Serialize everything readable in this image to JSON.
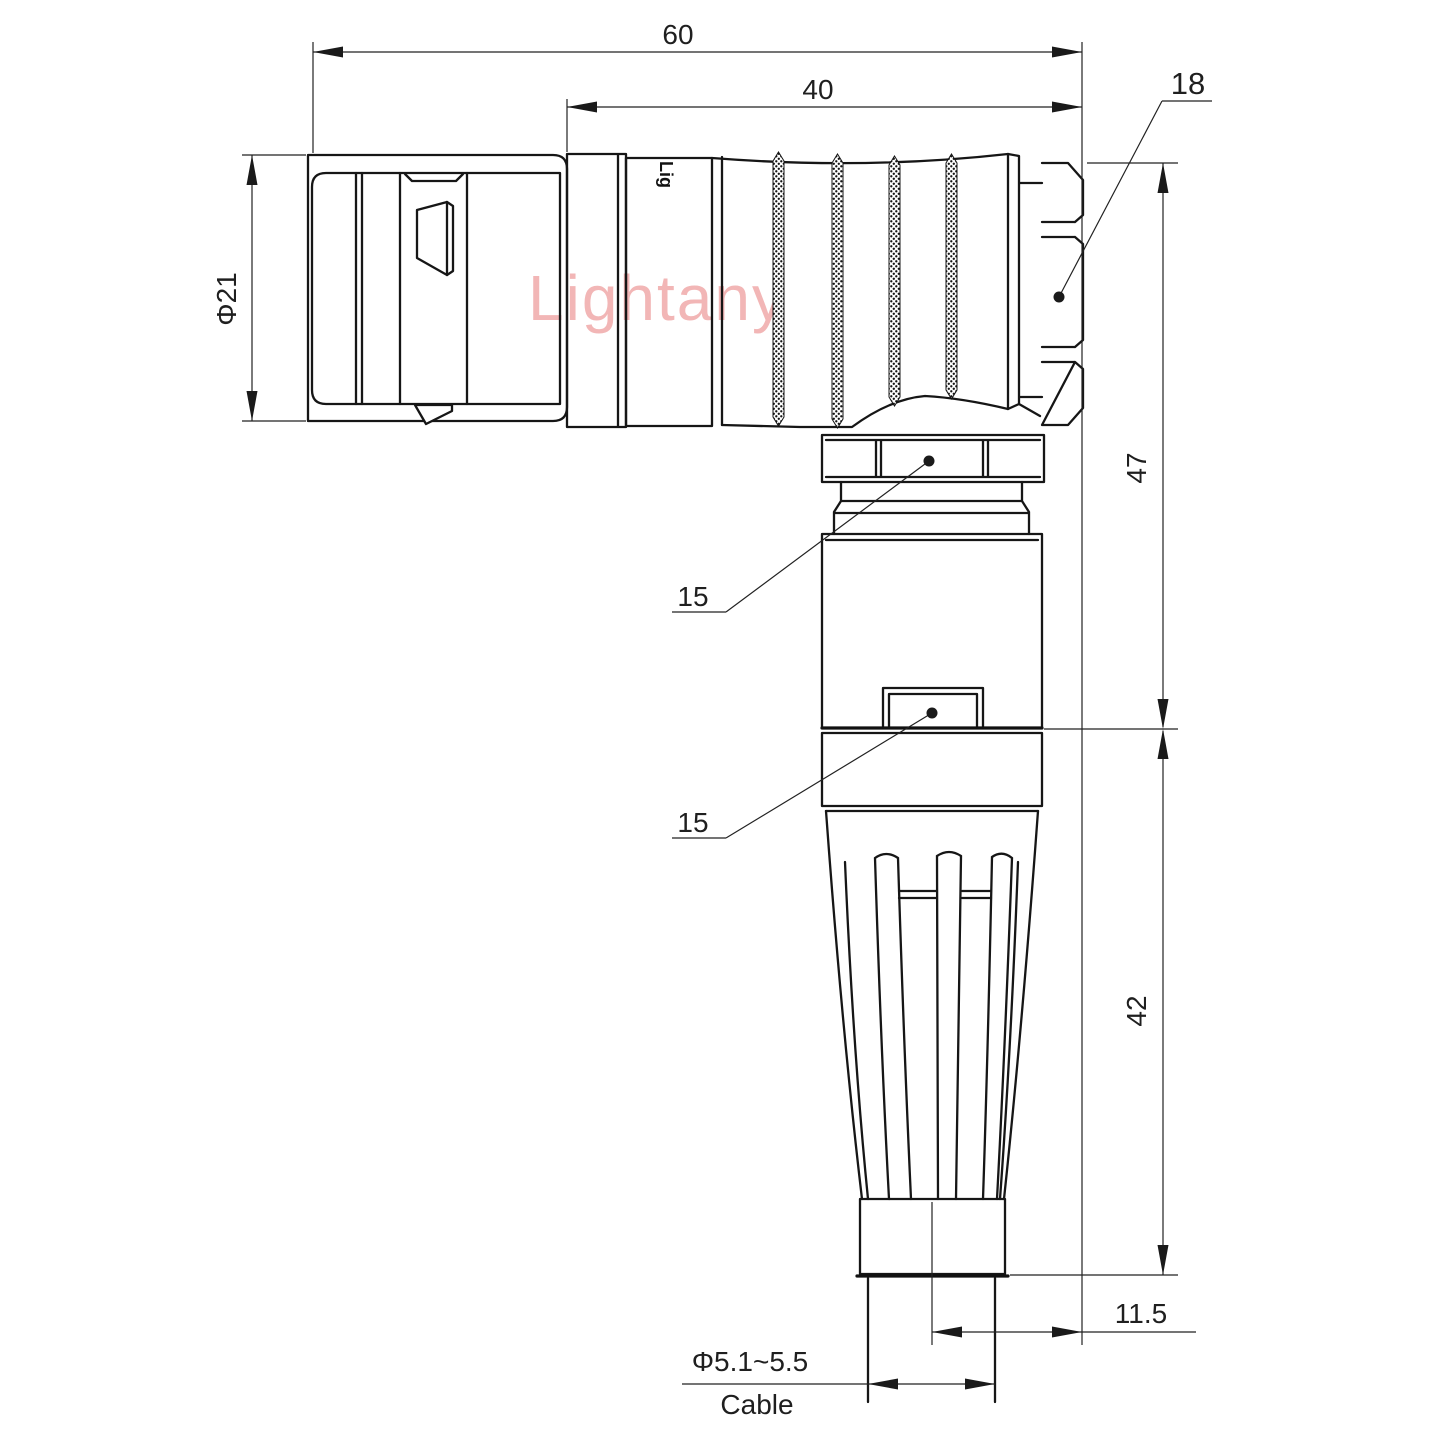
{
  "watermark": {
    "brand": "Lightany"
  },
  "engraving": {
    "text": "Lig"
  },
  "dimensions": {
    "overall_length": "60",
    "rear_section_length": "40",
    "nut_across_flats": "18",
    "shell_diameter": "Φ21",
    "upper_height": "47",
    "coupling_nut_flats": "15",
    "housing_flats": "15",
    "lower_height": "42",
    "axis_to_face_offset": "11.5",
    "cable_diameter_range": "Φ5.1~5.5",
    "cable_label": "Cable"
  }
}
